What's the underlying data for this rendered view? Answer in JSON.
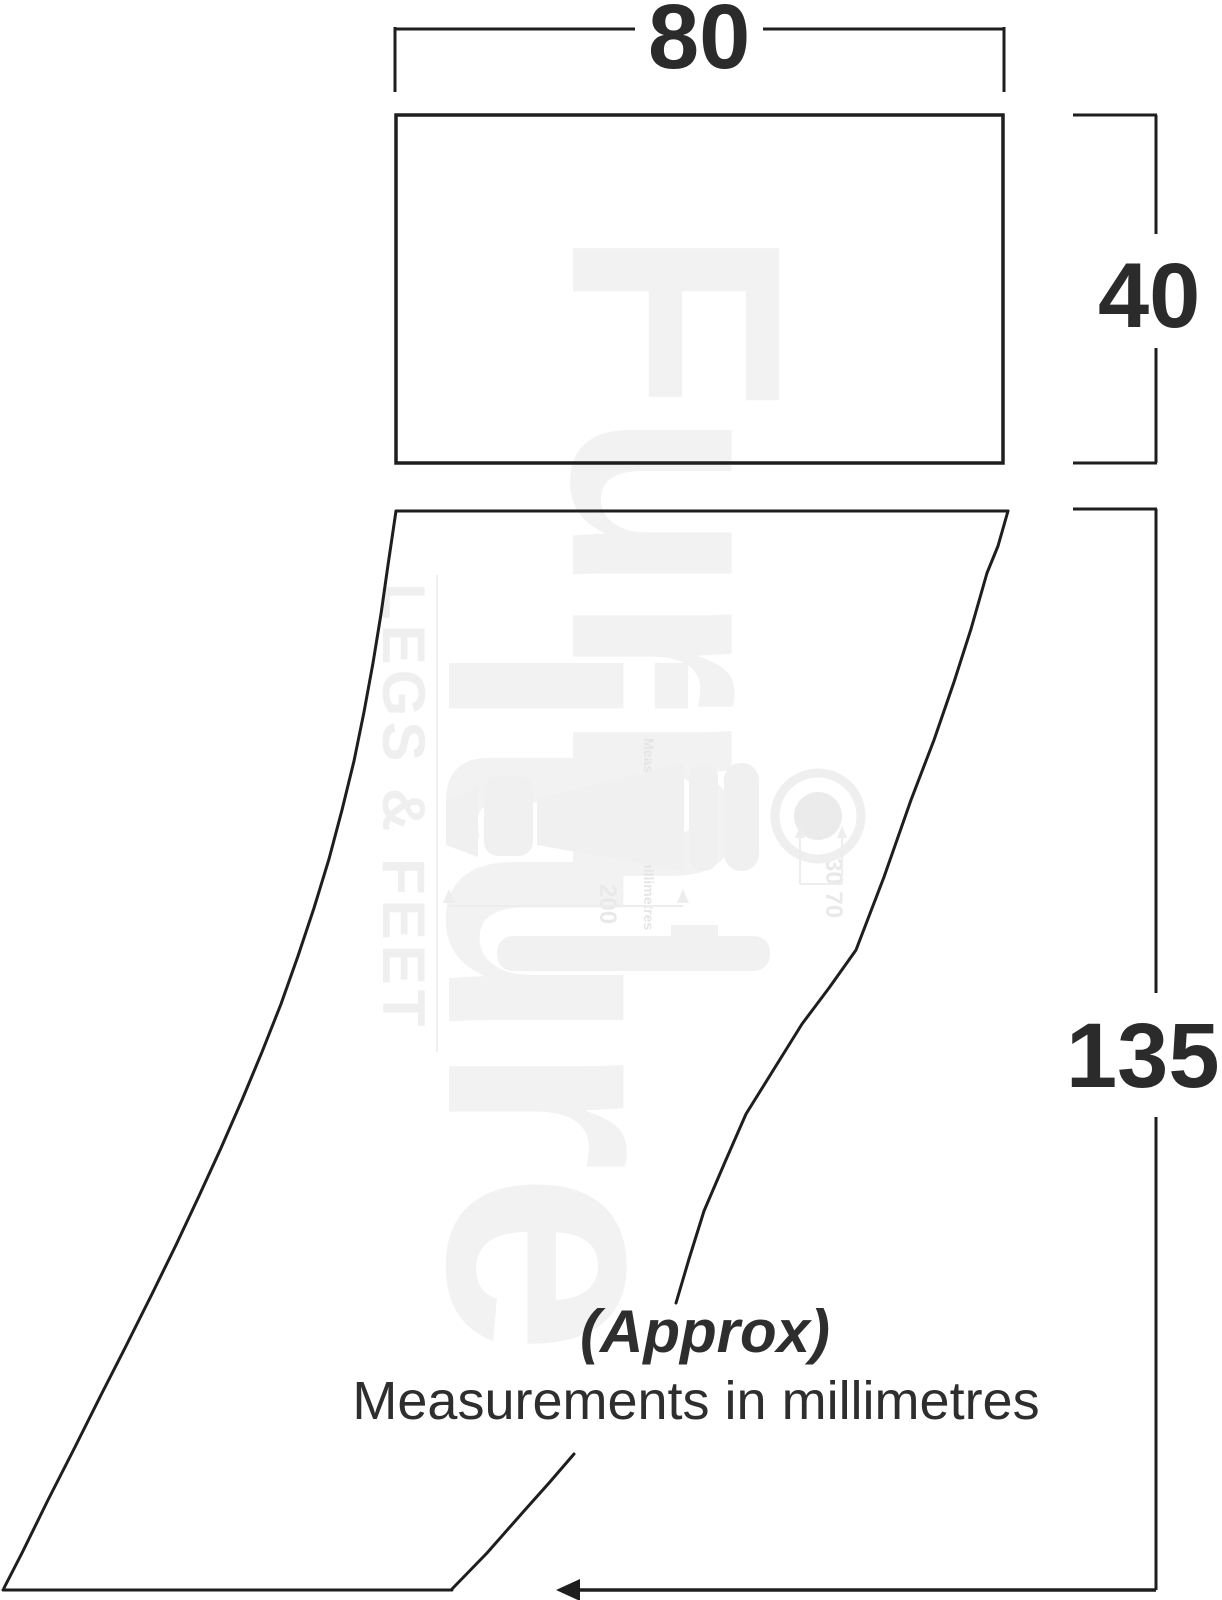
{
  "page": {
    "background": "#ffffff",
    "ink_color": "#1e1e1e",
    "label_color": "#2b2b2b",
    "watermark_color": "#f2f2f2"
  },
  "diagram": {
    "type": "furniture-leg-dimension-drawing",
    "dimensions": {
      "top_block_width_mm": "80",
      "top_block_height_mm": "40",
      "leg_height_mm": "135"
    },
    "notes": {
      "approx": "(Approx)",
      "units": "Measurements in millimetres"
    }
  },
  "watermark": {
    "brand_part1": "Furn",
    "brand_part2": "iture",
    "tagline": "LEGS & FEET",
    "small_note_line1": "(Approx)",
    "small_note_line2": "Measurements in millimetres",
    "dim_200": "200",
    "dim_30_70": "30 70"
  }
}
